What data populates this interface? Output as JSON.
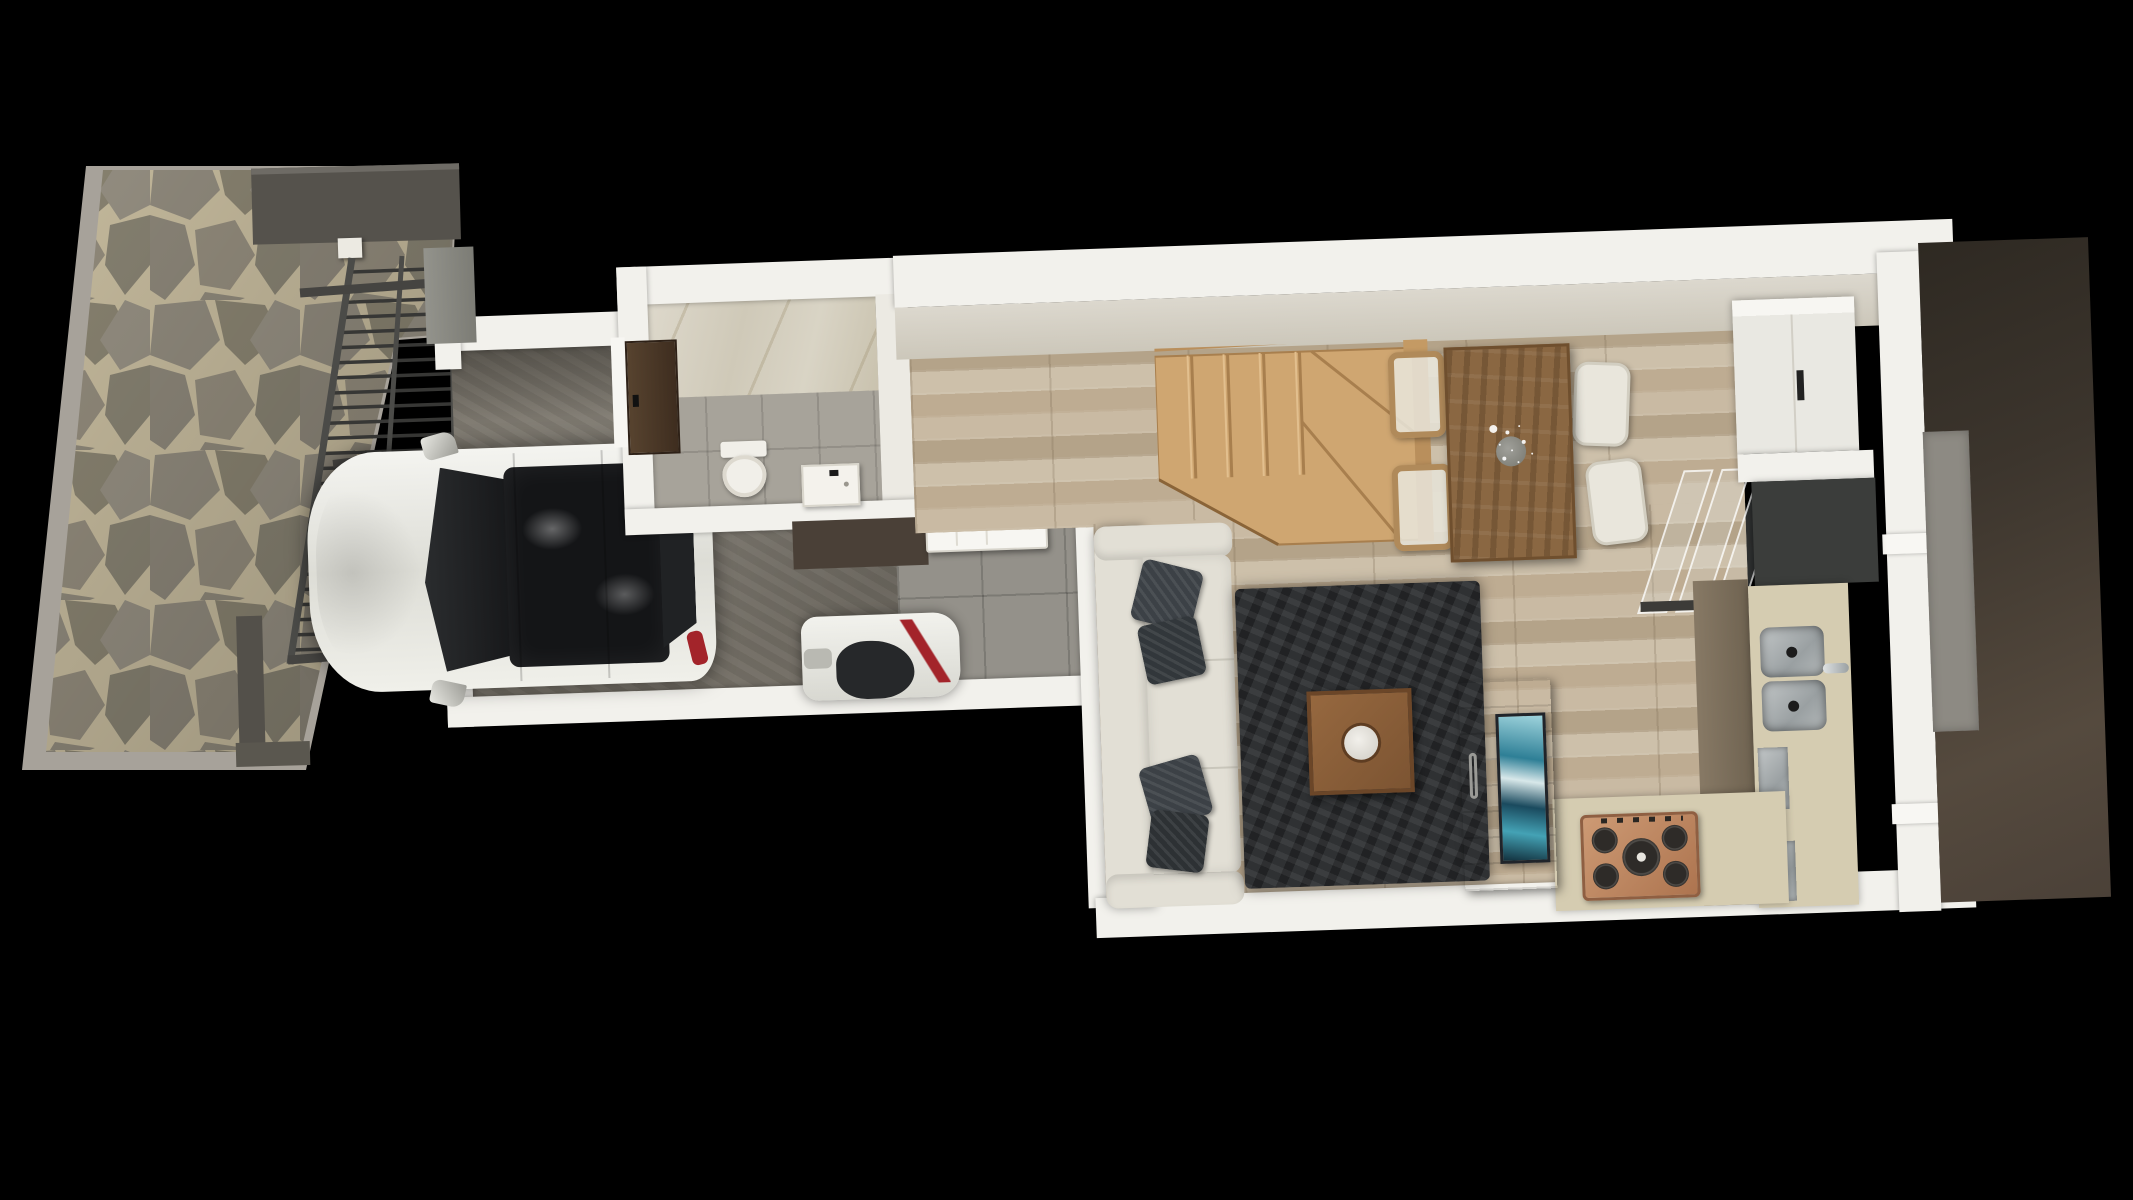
{
  "scene": {
    "type": "3d-floorplan-top-down-render",
    "background_color": "#000000",
    "house_rotation_deg": -2,
    "rooms": [
      "driveway-patio",
      "garage",
      "bathroom",
      "entry-hall",
      "living-room",
      "dining-area",
      "kitchen",
      "stairwell",
      "side-terrace"
    ]
  },
  "palette": {
    "flagstone": "#8d8779",
    "flagstone_joint": "#c3b89b",
    "curb": "#a7a29a",
    "pergola_slat": "#373735",
    "pergola_rail": "#4b4b48",
    "dark_wall": "#55524c",
    "wall_white": "#f2f1ec",
    "wall_inner_cream": "#d5d1c6",
    "garage_concrete": "#7a756b",
    "hall_tile": "#94918a",
    "bath_tile": "#a7a39a",
    "marble": "#d9d4c5",
    "wood_floor": "#c2b39b",
    "stair_wood": "#cfa671",
    "sofa_cream": "#e2dfd5",
    "pillow_charcoal": "#3c4146",
    "rug_charcoal": "#2f3133",
    "dining_table": "#8a6742",
    "chair_cream": "#e9e6dc",
    "counter_beige": "#d5ccb1",
    "cabinet_wood": "#7d6f5c",
    "counter_black": "#3b3d3b",
    "cooktop_copper": "#c08a64",
    "sink_steel": "#9aa0a2",
    "car_body": "#ededE8",
    "car_glass": "#17181a",
    "taillight_red": "#a3242a",
    "tv_screen_teal": "#2e7f96",
    "terrace_brown": "#4b4138",
    "door_walnut": "#4a382a"
  },
  "patio": {
    "material": "flagstone-crazy-paving",
    "stone": "#8d8779",
    "joint": "#c3b89b",
    "curb": "#a7a29a"
  },
  "pergola": {
    "slat_count": 26,
    "slat_color": "#373735",
    "rail_color": "#4b4b48",
    "beam_color": "#454441",
    "post_color": "#eceae2"
  },
  "garage": {
    "floor": "#7a756b",
    "door_state": "open-west-side"
  },
  "car": {
    "body": "#ededE8",
    "roof_glass": "#141517",
    "windshield": "#1b1d1f",
    "taillight": "#a3242a",
    "mirror_count": 2
  },
  "small_vehicle": {
    "body": "#efefea",
    "glass": "#26282a",
    "accent": "#a3242a"
  },
  "bathroom": {
    "toilet": {
      "color": "#f1efe9"
    },
    "basin": {
      "color": "#f4f2ec",
      "faucet": "#1a1a1a"
    },
    "door": {
      "panel": "#4a382a",
      "frame": "#f7f6f2",
      "handle": "#111111",
      "state": "open"
    }
  },
  "entry": {
    "door": {
      "panel": "#f7f6f2",
      "handle": "#111111",
      "state": "open"
    },
    "accent_wall": "#4a4037"
  },
  "living": {
    "sofa": {
      "color": "#e2dfd5",
      "pillows": 4,
      "pillow_color": "#3c4146"
    },
    "rug": {
      "color": "#2f3133",
      "style": "shag"
    },
    "coffee_table": {
      "top": "#8b5e3a",
      "tray": "#e8e6e1"
    },
    "tv_board": {
      "wood": "#7c5b3d",
      "screen_art": [
        "#2e7f96",
        "#9fd4dd",
        "#1a4a5e"
      ],
      "handle": "#9a9a96"
    }
  },
  "dining": {
    "table": {
      "color": "#8a6742",
      "vase": "#8e8e88",
      "flowers": "#ffffff"
    },
    "chairs": {
      "count": 4,
      "shell": "#e9e6dc",
      "frame": "#b08a5a"
    }
  },
  "stairs": {
    "tread_count": 4,
    "winder_count": 3,
    "wood": "#cfa671",
    "rail": "#b98f5c"
  },
  "kitchen": {
    "tall_cabinet": {
      "color": "#f4f3ee",
      "handle": "#222222"
    },
    "black_counter": "#3b3d3b",
    "counter": "#d5ccb1",
    "cabinet_front": "#7d6f5c",
    "sink": {
      "bowls": 2,
      "steel": "#9aa0a2",
      "faucet": "#c7cbcc"
    },
    "cooktop": {
      "burners": 5,
      "body": "#c08a64",
      "grate": "#2e2b28"
    },
    "appliances_steel": 2,
    "glass_balustrade_panels": 3
  },
  "exterior": {
    "terrace": "#4b4138",
    "side_strip": "#8d8a83",
    "nw_block": "#8b8b84"
  }
}
